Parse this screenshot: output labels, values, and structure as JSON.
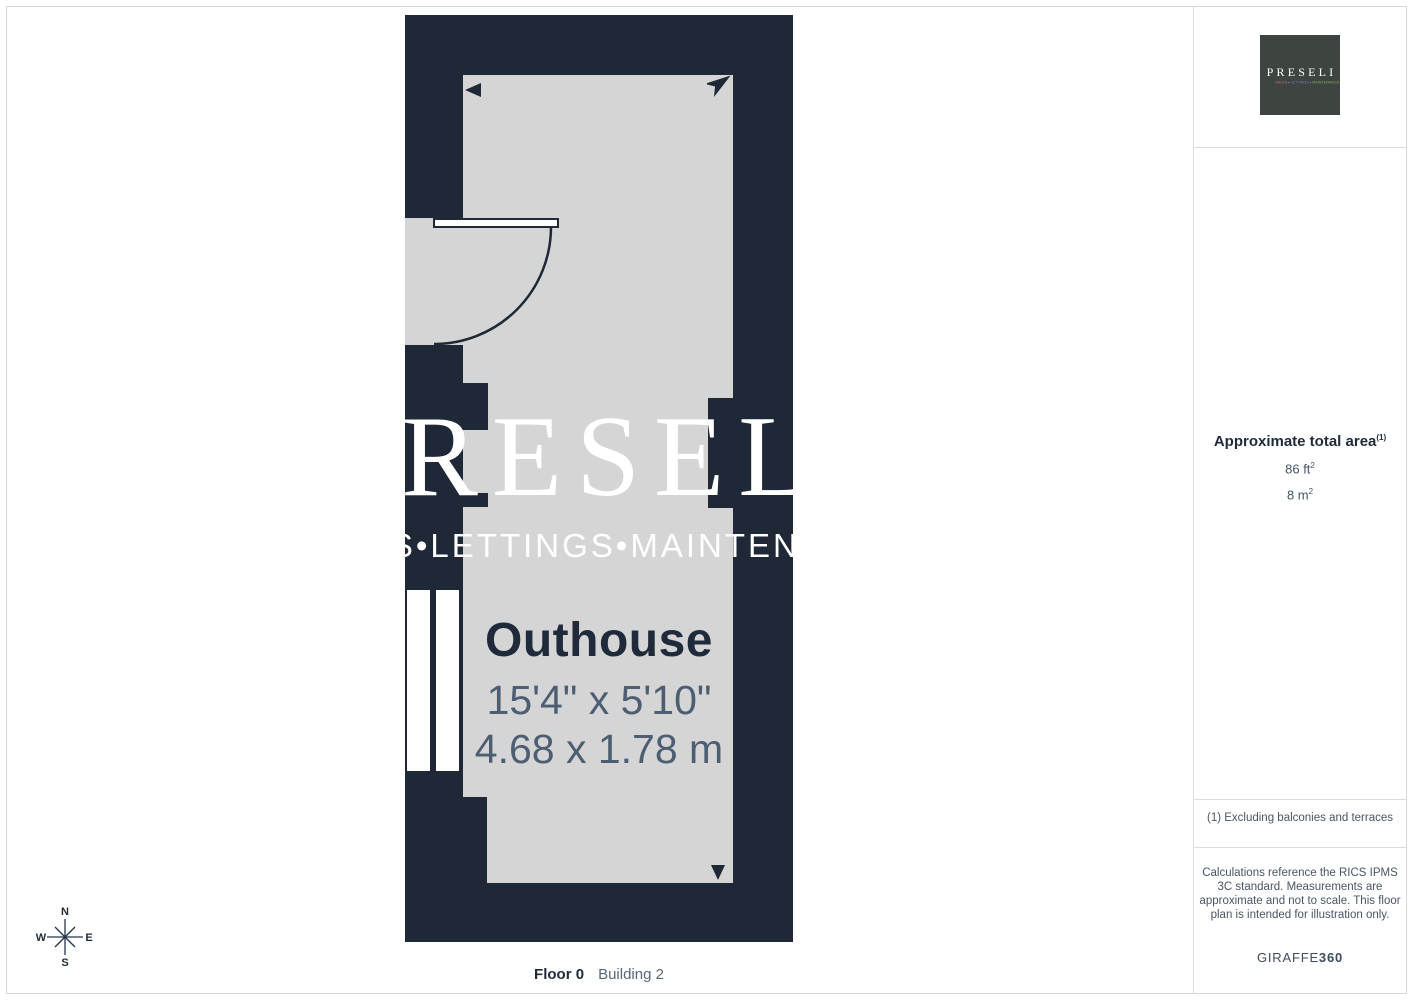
{
  "floorplan": {
    "room": {
      "name": "Outhouse",
      "dims_imperial": "15'4\" x 5'10\"",
      "dims_metric": "4.68 x 1.78 m"
    },
    "watermark": {
      "line1": "PRESELI",
      "line2": "SALES•LETTINGS•MAINTENANCE"
    },
    "footer": {
      "floor": "Floor 0",
      "building": "Building 2"
    }
  },
  "compass": {
    "north": "N",
    "east": "E",
    "south": "S",
    "west": "W"
  },
  "sidebar": {
    "logo": {
      "name": "PRESELI",
      "sub_sales": "SALES",
      "sub_lettings": "LETTINGS",
      "sub_maintenance": "MAINTENANCE",
      "separator": "•"
    },
    "area": {
      "title": "Approximate total area",
      "marker": "(1)",
      "imperial_value": "86 ft",
      "imperial_sup": "2",
      "metric_value": "8 m",
      "metric_sup": "2"
    },
    "footnote": "(1) Excluding balconies and terraces",
    "disclaimer": "Calculations reference the RICS IPMS 3C standard. Measurements are approximate and not to scale. This floor plan is intended for illustration only.",
    "brand": {
      "name": "GIRAFFE",
      "suffix": "360"
    }
  },
  "colors": {
    "wall_navy": "#1E2836",
    "floor_gray": "#D5D5D6",
    "logo_background": "#3E4440",
    "text_navy": "#1F2B3A",
    "text_dimension_gray": "#4D5E73",
    "text_muted_gray": "#4A5565",
    "logo_sales_pink": "#C9699B",
    "logo_lettings_purple": "#8C6FB5",
    "logo_maintenance_green": "#82A657"
  }
}
